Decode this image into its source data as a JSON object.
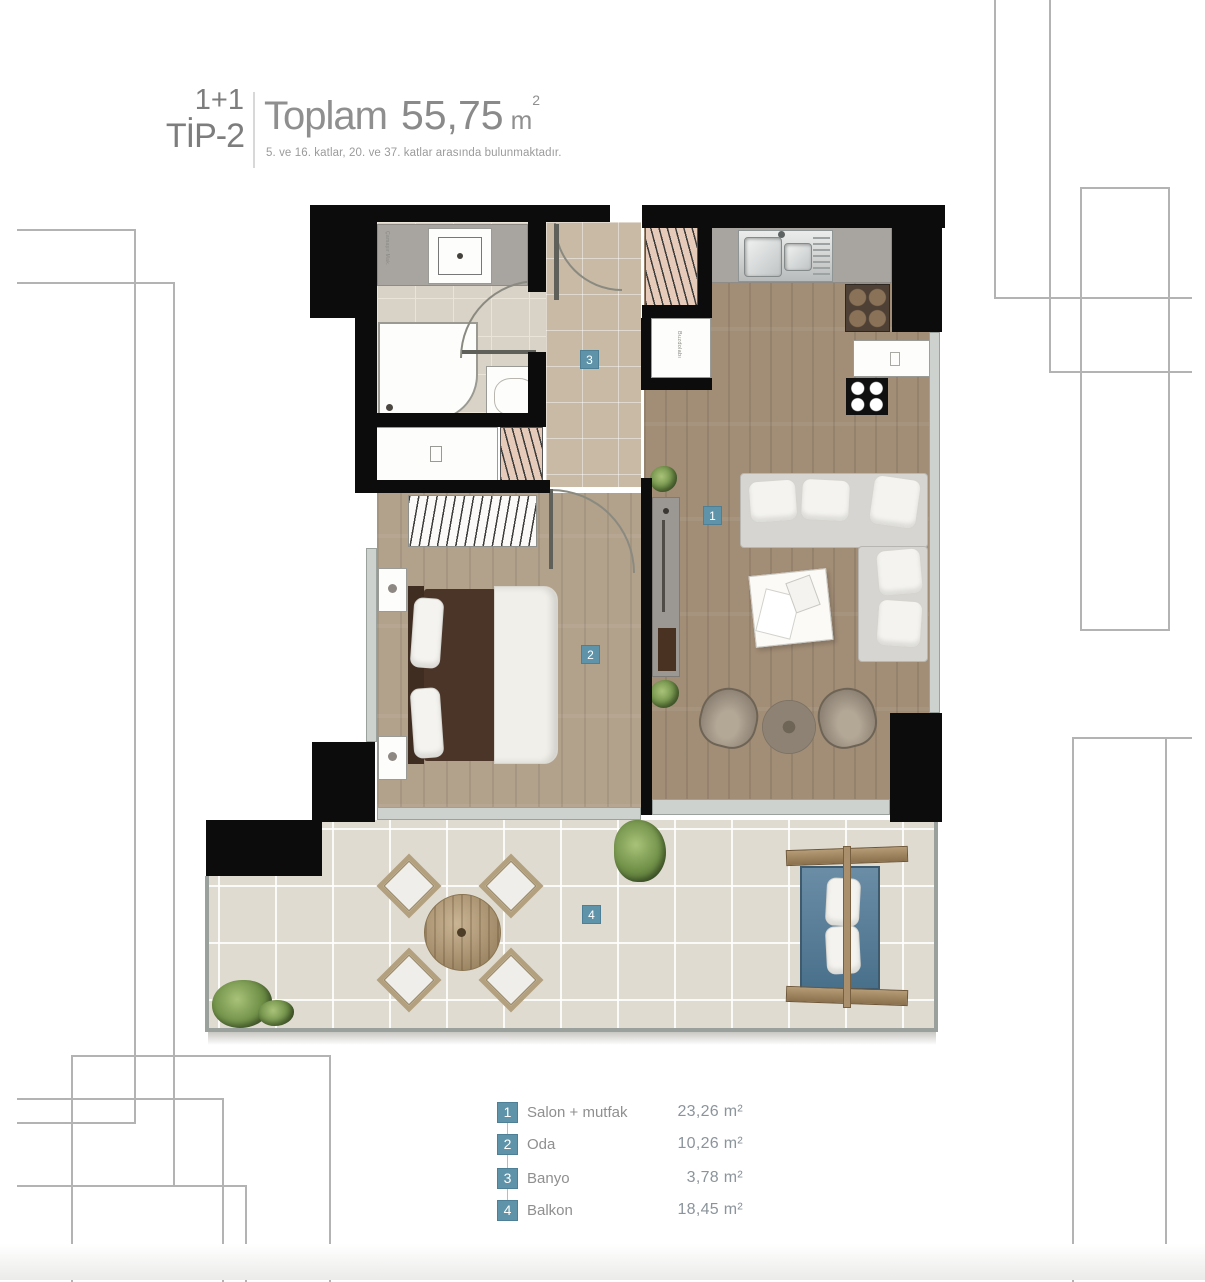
{
  "header": {
    "type_line1": "1+1",
    "type_line2": "TİP-2",
    "total_label": "Toplam",
    "total_value": "55,75",
    "total_unit": "m",
    "total_unit_sup": "2",
    "subtitle": "5. ve 16. katlar, 20. ve 37. katlar arasında bulunmaktadır."
  },
  "legend": {
    "items": [
      {
        "num": "1",
        "label": "Salon + mutfak",
        "area": "23,26 m²"
      },
      {
        "num": "2",
        "label": "Oda",
        "area": "10,26 m²"
      },
      {
        "num": "3",
        "label": "Banyo",
        "area": "3,78 m²"
      },
      {
        "num": "4",
        "label": "Balkon",
        "area": "18,45 m²"
      }
    ]
  },
  "plan": {
    "markers": {
      "salon": "1",
      "oda": "2",
      "banyo": "3",
      "balkon": "4"
    },
    "labels": {
      "fridge": "Buzdolabı",
      "washer": "Çamaşır Mak."
    }
  },
  "colors": {
    "marker_blue": "#5e93a9",
    "wall_black": "#0c0c0c",
    "wood_living": "#a28d76",
    "wood_bedroom": "#b2a18b",
    "tile_corridor": "#c8baa5",
    "tile_bathroom": "#d9d2c6",
    "tile_balcony": "#dfdbd1",
    "header_gray": "#8f8f8f"
  }
}
